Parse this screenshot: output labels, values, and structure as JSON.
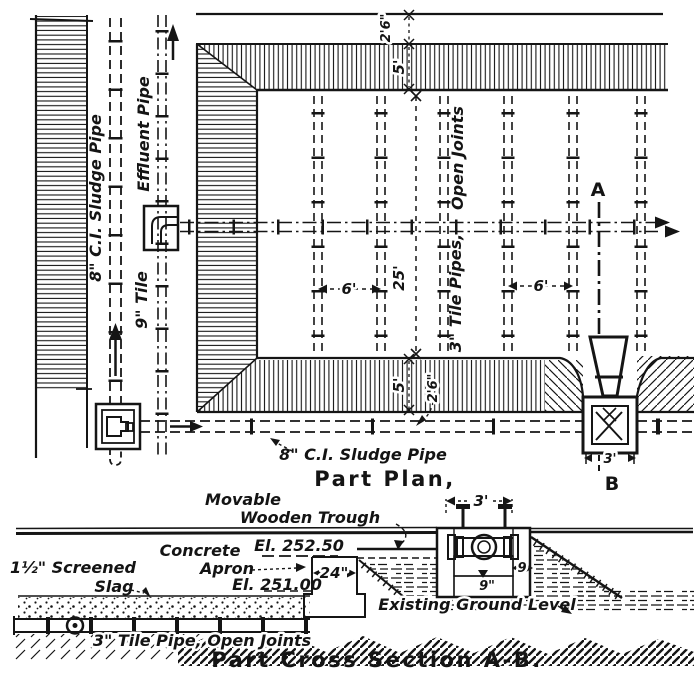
{
  "colors": {
    "ink": "#151515",
    "paper": "#ffffff"
  },
  "plan": {
    "title": "Part Plan,",
    "labels": {
      "sludge_pipe_vertical": "8\" C.I. Sludge Pipe",
      "effluent_pipe": "Effluent Pipe",
      "tile_main": "9\" Tile",
      "open_joints": "Open Joints",
      "tile_laterals": "3\" Tile Pipes,",
      "sludge_pipe_bottom": "8\" C.I. Sludge Pipe",
      "section_marker_a": "A",
      "section_marker_b": "B"
    },
    "dimensions": {
      "top_berm": "2'6\"",
      "top_slope": "5'",
      "lateral_spacing_left": "6'",
      "bed_width": "25'",
      "lateral_spacing_right": "6'",
      "bottom_slope": "5'",
      "bottom_berm": "2'6\"",
      "outlet_box_width": "3'"
    }
  },
  "section": {
    "title": "Part Cross Section A-B.",
    "labels": {
      "movable_line1": "Movable",
      "movable_line2": "Wooden Trough",
      "concrete_line1": "Concrete",
      "concrete_line2": "Apron",
      "elevation_top": "El. 252.50",
      "elevation_apron": "El. 251.00",
      "screened_line1": "1½\" Screened",
      "screened_line2": "Slag",
      "tile_pipe": "3\" Tile Pipe, Open Joints",
      "existing_ground": "Existing Ground Level"
    },
    "dimensions": {
      "apron_width": "24\"",
      "trough_width": "3'",
      "wall_thickness_side": "9",
      "wall_thickness_bottom": "9\""
    }
  }
}
